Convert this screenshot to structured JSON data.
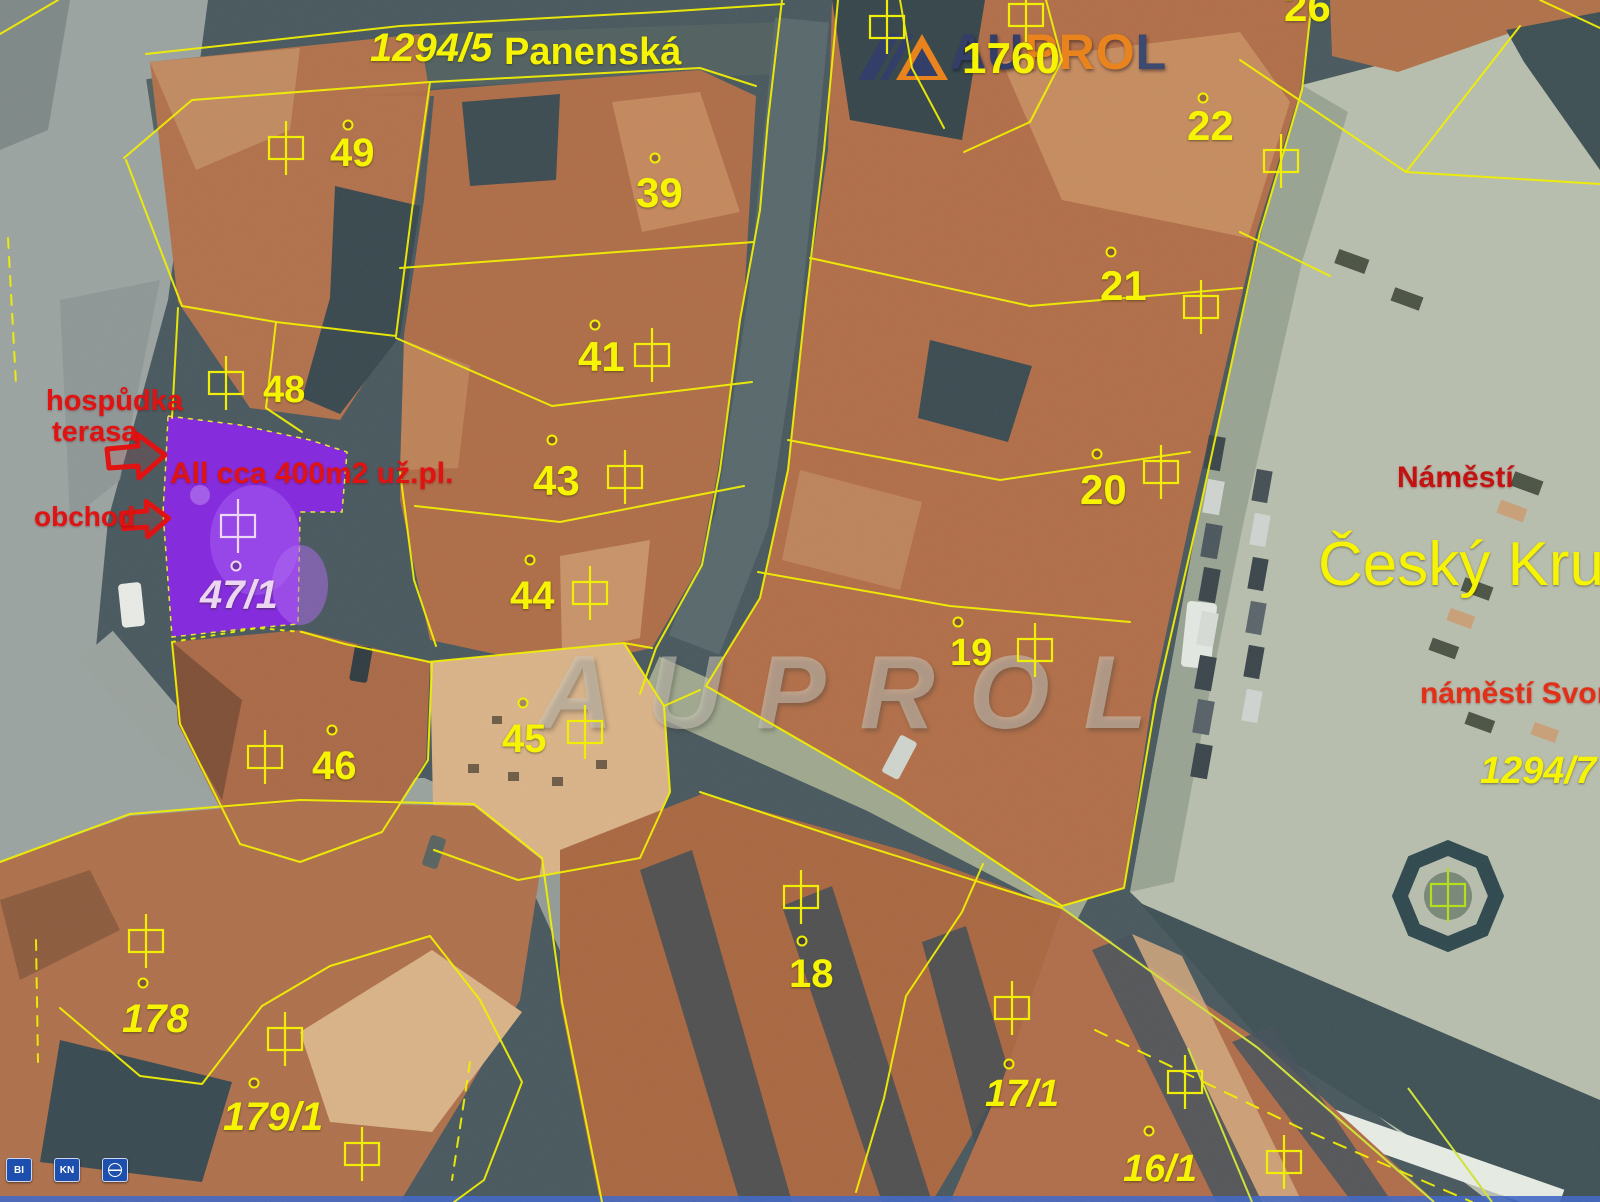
{
  "watermark": {
    "text": "AUPROL"
  },
  "logo": {
    "text": "AUPROL",
    "letters": [
      {
        "ch": "A",
        "color": "#333f69"
      },
      {
        "ch": "U",
        "color": "#333f69"
      },
      {
        "ch": "P",
        "color": "#e8831d"
      },
      {
        "ch": "R",
        "color": "#e8831d"
      },
      {
        "ch": "O",
        "color": "#e8831d"
      },
      {
        "ch": "L",
        "color": "#3d4a70"
      }
    ]
  },
  "map_labels": [
    {
      "text": "1294/5",
      "x": 370,
      "y": 28,
      "size": 40,
      "italic": true
    },
    {
      "text": "Panenská",
      "x": 504,
      "y": 33,
      "size": 38
    },
    {
      "text": "1760",
      "x": 962,
      "y": 37,
      "size": 44
    },
    {
      "text": "26",
      "x": 1284,
      "y": -14,
      "size": 42
    },
    {
      "text": "22",
      "x": 1187,
      "y": 105,
      "size": 42
    },
    {
      "text": "49",
      "x": 330,
      "y": 133,
      "size": 40
    },
    {
      "text": "39",
      "x": 636,
      "y": 172,
      "size": 42
    },
    {
      "text": "21",
      "x": 1100,
      "y": 265,
      "size": 42
    },
    {
      "text": "41",
      "x": 578,
      "y": 336,
      "size": 42
    },
    {
      "text": "48",
      "x": 263,
      "y": 371,
      "size": 38
    },
    {
      "text": "43",
      "x": 533,
      "y": 460,
      "size": 42
    },
    {
      "text": "20",
      "x": 1080,
      "y": 469,
      "size": 42
    },
    {
      "text": "44",
      "x": 510,
      "y": 576,
      "size": 40
    },
    {
      "text": "19",
      "x": 950,
      "y": 634,
      "size": 38
    },
    {
      "text": "46",
      "x": 312,
      "y": 746,
      "size": 40
    },
    {
      "text": "45",
      "x": 502,
      "y": 719,
      "size": 40
    },
    {
      "text": "47/1",
      "x": 200,
      "y": 575,
      "size": 40,
      "italic": true,
      "color": "#edd6f2"
    },
    {
      "text": "Český Krum",
      "x": 1318,
      "y": 534,
      "size": 62,
      "weight": "normal"
    },
    {
      "text": "1294/7",
      "x": 1480,
      "y": 752,
      "size": 38,
      "italic": true
    },
    {
      "text": "18",
      "x": 789,
      "y": 954,
      "size": 40
    },
    {
      "text": "178",
      "x": 122,
      "y": 999,
      "size": 40,
      "italic": true
    },
    {
      "text": "179/1",
      "x": 223,
      "y": 1097,
      "size": 40,
      "italic": true
    },
    {
      "text": "17/1",
      "x": 985,
      "y": 1075,
      "size": 38,
      "italic": true
    },
    {
      "text": "16/1",
      "x": 1123,
      "y": 1150,
      "size": 38,
      "italic": true
    }
  ],
  "annotations": [
    {
      "text": "hospůdka",
      "x": 46,
      "y": 386,
      "size": 29,
      "color": "#e01212"
    },
    {
      "text": "terasa",
      "x": 52,
      "y": 417,
      "size": 29,
      "color": "#e01212"
    },
    {
      "text": "All cca 400m2 už.pl.",
      "x": 170,
      "y": 458,
      "size": 30,
      "color": "#e01212"
    },
    {
      "text": "obchod",
      "x": 34,
      "y": 502,
      "size": 28,
      "color": "#e01212"
    },
    {
      "text": "Náměstí",
      "x": 1397,
      "y": 462,
      "size": 30,
      "color": "#c31212"
    },
    {
      "text": "náměstí Svorn",
      "x": 1420,
      "y": 678,
      "size": 30,
      "color": "#e23018"
    }
  ],
  "cadastre": {
    "building_symbols": [
      [
        286,
        148
      ],
      [
        887,
        27
      ],
      [
        1026,
        15
      ],
      [
        1281,
        161
      ],
      [
        1201,
        307
      ],
      [
        1161,
        472
      ],
      [
        226,
        383
      ],
      [
        652,
        355
      ],
      [
        625,
        477
      ],
      [
        590,
        593
      ],
      [
        1035,
        650
      ],
      [
        265,
        757
      ],
      [
        585,
        732
      ],
      [
        801,
        897
      ],
      [
        146,
        941
      ],
      [
        285,
        1039
      ],
      [
        362,
        1154
      ],
      [
        1012,
        1008
      ],
      [
        1185,
        1082
      ],
      [
        1284,
        1162
      ],
      [
        238,
        526,
        "#ecd8f4"
      ],
      [
        1448,
        895,
        "#b2e01c"
      ]
    ],
    "point_markers": [
      [
        348,
        125
      ],
      [
        655,
        158
      ],
      [
        595,
        325
      ],
      [
        552,
        440
      ],
      [
        530,
        560
      ],
      [
        1203,
        98
      ],
      [
        1111,
        252
      ],
      [
        1097,
        454
      ],
      [
        332,
        730
      ],
      [
        523,
        703
      ],
      [
        958,
        622
      ],
      [
        802,
        941
      ],
      [
        143,
        983
      ],
      [
        254,
        1083
      ],
      [
        1009,
        1064
      ],
      [
        1149,
        1131
      ],
      [
        236,
        566,
        "#ecd8f4"
      ]
    ]
  },
  "corner_buttons": [
    {
      "label": "BI",
      "name": "layer-button-bi"
    },
    {
      "label": "KN",
      "name": "layer-button-kn"
    },
    {
      "label": "",
      "icon": "globe",
      "name": "layer-button-globe"
    }
  ],
  "colors": {
    "cadastre_line": "#f0ee04",
    "cadastre_line_green": "#cfe23c",
    "label_yellow": "#f6f303",
    "parcel_highlight": "#8a2ae6",
    "annotation_red": "#e01212",
    "logo_navy": "#333f69",
    "logo_orange": "#e8831d"
  }
}
